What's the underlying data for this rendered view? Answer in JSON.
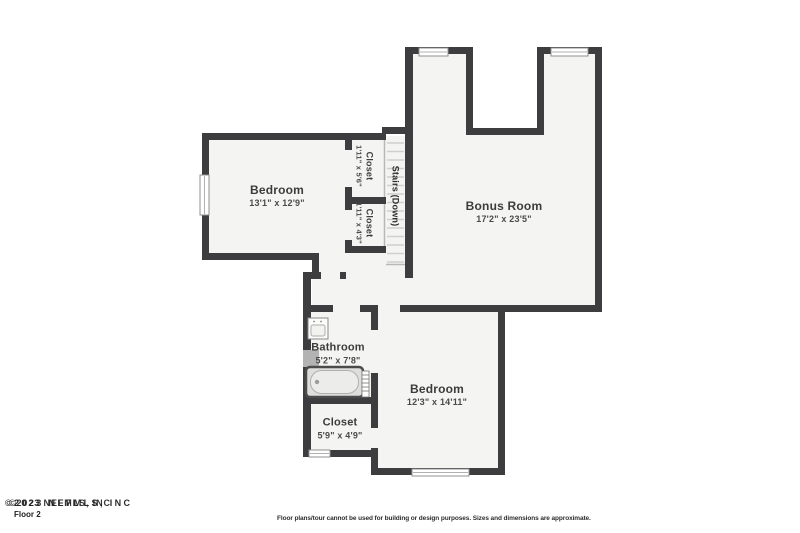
{
  "plan": {
    "floor_label": "Floor 2",
    "watermark": "©2023 NEFMLS, INC",
    "disclaimer": "Floor plans/tour cannot be used for building or design purposes. Sizes and dimensions are approximate.",
    "rooms": {
      "bedroom_upper": {
        "name": "Bedroom",
        "dims": "13'1\" x 12'9\""
      },
      "closet_upper_top": {
        "name": "Closet",
        "dims": "1'11\" x 5'6\""
      },
      "closet_upper_bottom": {
        "name": "Closet",
        "dims": "1'11\" x 4'3\""
      },
      "stairs": {
        "name": "Stairs (Down)"
      },
      "bonus_room": {
        "name": "Bonus Room",
        "dims": "17'2\" x 23'5\""
      },
      "bathroom": {
        "name": "Bathroom",
        "dims": "5'2\" x 7'8\""
      },
      "bedroom_lower": {
        "name": "Bedroom",
        "dims": "12'3\" x 14'11\""
      },
      "closet_lower": {
        "name": "Closet",
        "dims": "5'9\" x 4'9\""
      }
    },
    "colors": {
      "wall": "#3d3d3f",
      "floor": "#f4f4f2",
      "tread": "#cfcfcf"
    }
  }
}
